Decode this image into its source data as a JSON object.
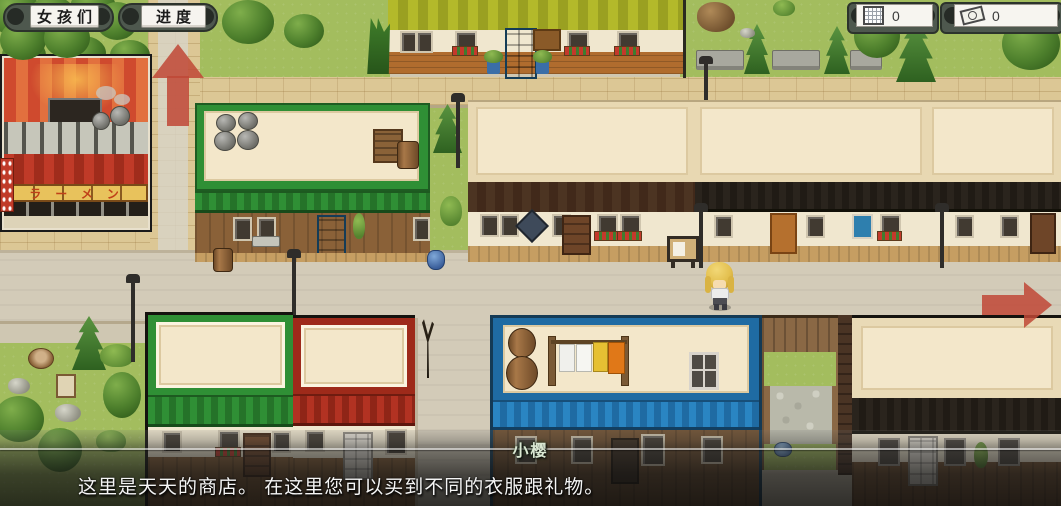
{
  "hud": {
    "girls_button_label": "女孩们",
    "progress_button_label": "进度",
    "day_counter_value": "0",
    "money_counter_value": "0"
  },
  "shops": {
    "ramen_sign_text": "ラーメン"
  },
  "dialogue": {
    "speaker_name": "小樱",
    "text": "这里是天天的商店。 在这里您可以买到不同的衣服跟礼物。"
  },
  "colors": {
    "arrow_red": "#bf4836",
    "hud_button_bg": "#f6f4ef",
    "dialogue_overlay": "rgba(20,20,20,0.78)",
    "speaker_name_color": "#d9e8d2"
  }
}
